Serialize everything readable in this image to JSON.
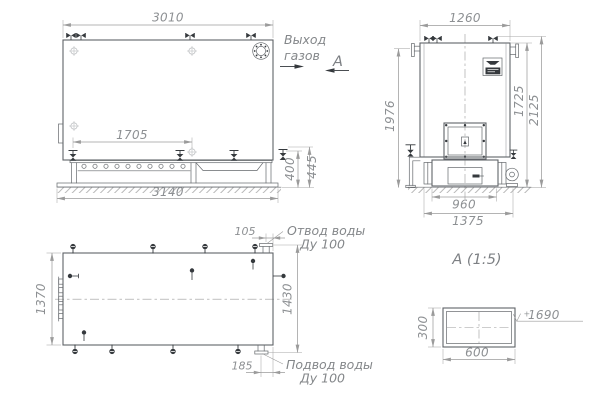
{
  "colors": {
    "background": "#ffffff",
    "outline": "#5f6368",
    "dim_line": "#9b9b9b",
    "dim_text": "#8d9093",
    "dark_fill": "#35393d"
  },
  "front_view": {
    "dims": {
      "top_width": "3010",
      "grate_length": "1705",
      "overall_width": "3140",
      "base_height": "400",
      "base_height_total": "445"
    }
  },
  "side_view": {
    "dims": {
      "top_width": "1260",
      "flue_height": "1976",
      "body_height": "1725",
      "overall_height": "2125",
      "base_width": "960",
      "base_overall_width": "1375"
    }
  },
  "plan_view": {
    "dims": {
      "depth": "1370",
      "overall_depth": "1430",
      "outlet_offset": "105",
      "inlet_offset": "185"
    },
    "labels": {
      "outlet_line1": "Отвод воды",
      "outlet_line2": "Ду 100",
      "inlet_line1": "Подвод воды",
      "inlet_line2": "Ду 100"
    }
  },
  "annotations": {
    "gas_line1": "Выход",
    "gas_line2": "газов",
    "section_letter": "А"
  },
  "detail_a": {
    "title": "А (1:5)",
    "dims": {
      "height": "300",
      "width": "600",
      "elevation_prefix": "+",
      "elevation_value": "1690"
    }
  }
}
